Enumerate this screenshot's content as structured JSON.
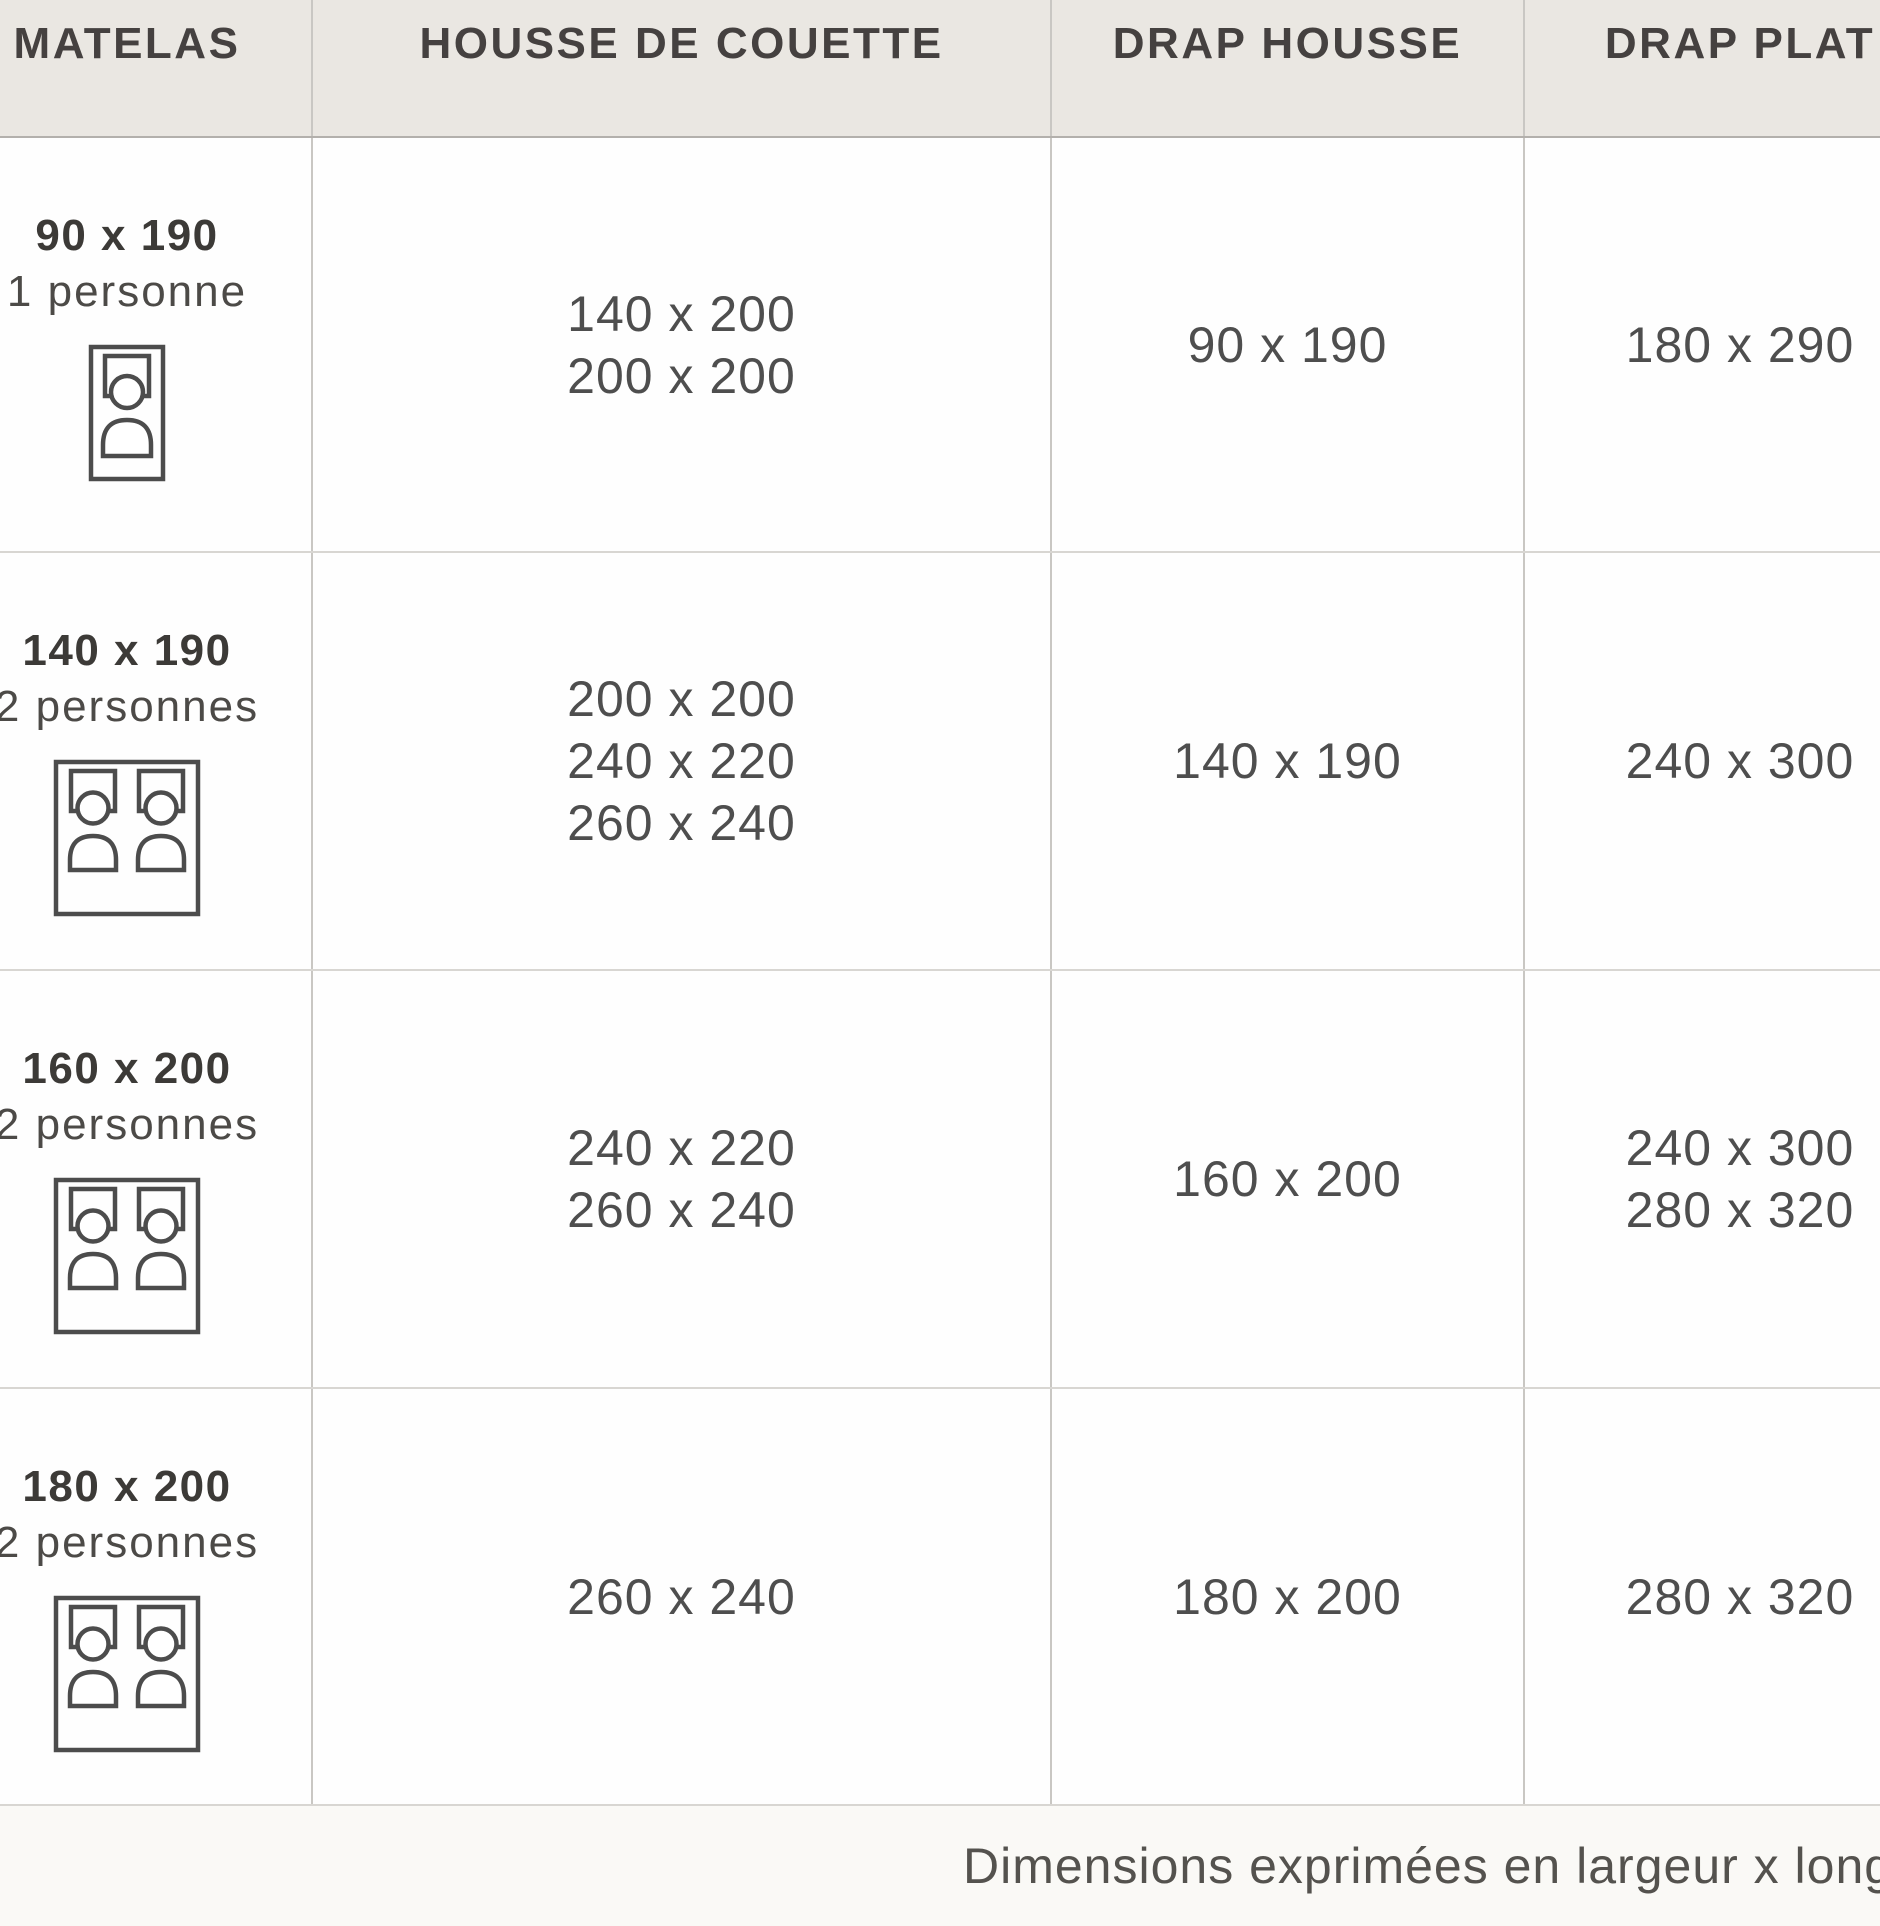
{
  "table": {
    "headers": [
      "MATELAS",
      "HOUSSE DE COUETTE",
      "DRAP HOUSSE",
      "DRAP PLAT"
    ],
    "rows": [
      {
        "matelas": "90 x 190",
        "capacity": "1 personne",
        "icon": "single-sleeper-bed-icon",
        "housse_de_couette": [
          "140 x 200",
          "200 x 200"
        ],
        "drap_housse": "90 x 190",
        "drap_plat": [
          "180 x 290"
        ]
      },
      {
        "matelas": "140 x 190",
        "capacity": "2 personnes",
        "icon": "double-sleeper-bed-icon",
        "housse_de_couette": [
          "200 x 200",
          "240 x 220",
          "260 x 240"
        ],
        "drap_housse": "140 x 190",
        "drap_plat": [
          "240 x 300"
        ]
      },
      {
        "matelas": "160 x 200",
        "capacity": "2 personnes",
        "icon": "double-sleeper-bed-icon",
        "housse_de_couette": [
          "240 x 220",
          "260 x 240"
        ],
        "drap_housse": "160 x 200",
        "drap_plat": [
          "240 x 300",
          "280 x 320"
        ]
      },
      {
        "matelas": "180 x 200",
        "capacity": "2 personnes",
        "icon": "double-sleeper-bed-icon",
        "housse_de_couette": [
          "260 x 240"
        ],
        "drap_housse": "180 x 200",
        "drap_plat": [
          "280 x 320"
        ]
      }
    ]
  },
  "footer": {
    "note": "Dimensions exprimées en largeur x longueur (cm"
  },
  "colors": {
    "header_bg": "#eae7e2",
    "header_text": "#454140",
    "cell_bg": "#fefefe",
    "value_text": "#4e4e4e",
    "title_text": "#3c3a37",
    "grid_line": "#c9c7c3",
    "icon_stroke": "#4c4c4c"
  }
}
